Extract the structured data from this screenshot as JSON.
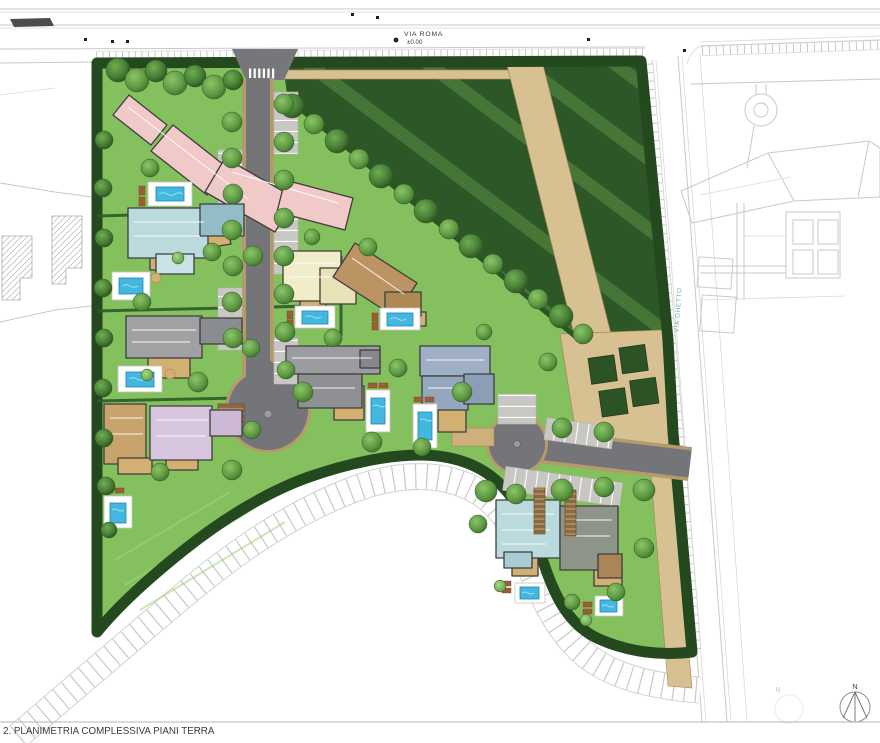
{
  "drawing": {
    "title": "2. PLANIMETRIA COMPLESSIVA PIANI TERRA"
  },
  "streets": {
    "via_roma": {
      "name": "VIA ROMA",
      "elevation": "±0.00"
    },
    "via_ghetto": {
      "name": "VIA GHETTO"
    }
  },
  "compass": {
    "north_label": "N",
    "secondary_north_label": "N"
  },
  "palette": {
    "lawn": "#84c05e",
    "meadow": "#2e5728",
    "meadow_stripe": "#4a7a39",
    "hedge": "#24491e",
    "asphalt": "#747578",
    "road_edge_tan": "#b59a6b",
    "path_beige": "#d7c092",
    "plaza_parterre": "#2c5226",
    "pool_water": "#44b7e0",
    "pool_deck": "#ffffff",
    "context_line": "#c9c9c9",
    "via_ghetto_label_color": "#69b2b6",
    "villa_pink": "#f0c9c8",
    "villa_cyan": "#badade",
    "villa_gray": "#a0a1a3",
    "villa_slate": "#9fb0c6",
    "villa_lilac": "#d8c6de",
    "villa_cream": "#f1ecca",
    "villa_brown": "#bc9464",
    "villa_tan": "#c8a36b",
    "patio_tan": "#d3af72"
  }
}
